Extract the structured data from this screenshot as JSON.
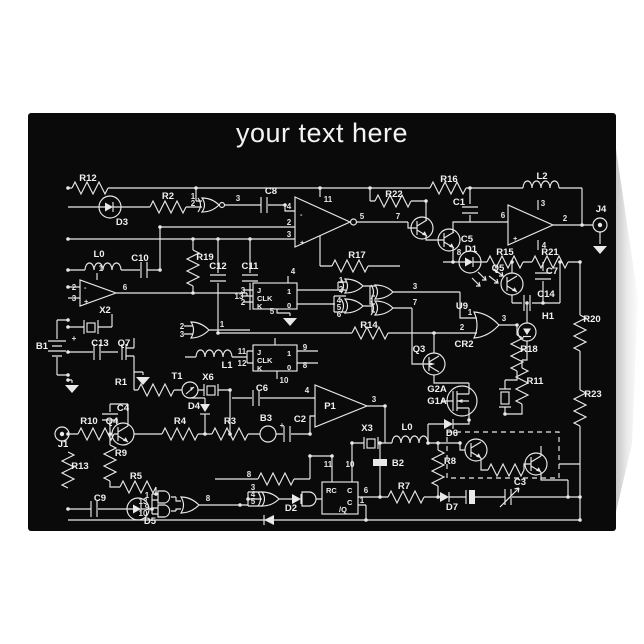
{
  "page": {
    "background_color": "#ffffff"
  },
  "card": {
    "title": "your text here",
    "front_color": "#0a0a0a",
    "line_color": "#e9e9e9",
    "title_color": "#f3f3f3",
    "back_edge_color": "#d9d9d9"
  },
  "schematic": {
    "description": "circuit-schematic-artwork",
    "component_labels": [
      {
        "t": "R12",
        "x": 88,
        "y": 181
      },
      {
        "t": "D3",
        "x": 122,
        "y": 225
      },
      {
        "t": "R2",
        "x": 168,
        "y": 199
      },
      {
        "t": "C8",
        "x": 271,
        "y": 194
      },
      {
        "t": "R22",
        "x": 394,
        "y": 197
      },
      {
        "t": "R16",
        "x": 449,
        "y": 182
      },
      {
        "t": "L2",
        "x": 542,
        "y": 179
      },
      {
        "t": "C1",
        "x": 459,
        "y": 205
      },
      {
        "t": "J4",
        "x": 601,
        "y": 212
      },
      {
        "t": "C5",
        "x": 467,
        "y": 242
      },
      {
        "t": "D1",
        "x": 471,
        "y": 252
      },
      {
        "t": "R15",
        "x": 505,
        "y": 255
      },
      {
        "t": "R21",
        "x": 550,
        "y": 255
      },
      {
        "t": "Q5",
        "x": 498,
        "y": 271
      },
      {
        "t": "C7",
        "x": 552,
        "y": 274
      },
      {
        "t": "C14",
        "x": 546,
        "y": 297
      },
      {
        "t": "L0",
        "x": 99,
        "y": 257
      },
      {
        "t": "C10",
        "x": 140,
        "y": 261
      },
      {
        "t": "R19",
        "x": 205,
        "y": 260
      },
      {
        "t": "C12",
        "x": 218,
        "y": 269
      },
      {
        "t": "C11",
        "x": 250,
        "y": 269
      },
      {
        "t": "R17",
        "x": 357,
        "y": 258
      },
      {
        "t": "R14",
        "x": 369,
        "y": 328
      },
      {
        "t": "U9",
        "x": 462,
        "y": 309
      },
      {
        "t": "CR2",
        "x": 464,
        "y": 347
      },
      {
        "t": "Q3",
        "x": 419,
        "y": 352
      },
      {
        "t": "H1",
        "x": 548,
        "y": 319
      },
      {
        "t": "R20",
        "x": 592,
        "y": 322
      },
      {
        "t": "R18",
        "x": 529,
        "y": 352
      },
      {
        "t": "R11",
        "x": 535,
        "y": 384
      },
      {
        "t": "R23",
        "x": 593,
        "y": 397
      },
      {
        "t": "G2A",
        "x": 437,
        "y": 392
      },
      {
        "t": "G1A",
        "x": 437,
        "y": 404
      },
      {
        "t": "D6",
        "x": 452,
        "y": 436
      },
      {
        "t": "X2",
        "x": 105,
        "y": 313
      },
      {
        "t": "B1",
        "x": 42,
        "y": 349
      },
      {
        "t": "C13",
        "x": 100,
        "y": 346
      },
      {
        "t": "Q7",
        "x": 124,
        "y": 346
      },
      {
        "t": "R1",
        "x": 121,
        "y": 385
      },
      {
        "t": "T1",
        "x": 177,
        "y": 379
      },
      {
        "t": "X6",
        "x": 208,
        "y": 380
      },
      {
        "t": "L1",
        "x": 227,
        "y": 368
      },
      {
        "t": "J1",
        "x": 63,
        "y": 447
      },
      {
        "t": "R10",
        "x": 89,
        "y": 424
      },
      {
        "t": "Q4",
        "x": 112,
        "y": 424
      },
      {
        "t": "C4",
        "x": 123,
        "y": 411
      },
      {
        "t": "R9",
        "x": 121,
        "y": 456
      },
      {
        "t": "R13",
        "x": 80,
        "y": 469
      },
      {
        "t": "R5",
        "x": 136,
        "y": 479
      },
      {
        "t": "C9",
        "x": 100,
        "y": 501
      },
      {
        "t": "D5",
        "x": 150,
        "y": 524
      },
      {
        "t": "R4",
        "x": 180,
        "y": 424
      },
      {
        "t": "R3",
        "x": 230,
        "y": 424
      },
      {
        "t": "B3",
        "x": 266,
        "y": 421
      },
      {
        "t": "C2",
        "x": 300,
        "y": 422
      },
      {
        "t": "C6",
        "x": 262,
        "y": 391
      },
      {
        "t": "P1",
        "x": 330,
        "y": 409
      },
      {
        "t": "X3",
        "x": 367,
        "y": 431
      },
      {
        "t": "L0",
        "x": 407,
        "y": 430
      },
      {
        "t": "B2",
        "x": 398,
        "y": 466
      },
      {
        "t": "R8",
        "x": 450,
        "y": 464
      },
      {
        "t": "R7",
        "x": 404,
        "y": 489
      },
      {
        "t": "D7",
        "x": 452,
        "y": 510
      },
      {
        "t": "C3",
        "x": 520,
        "y": 485
      },
      {
        "t": "D2",
        "x": 291,
        "y": 511
      },
      {
        "t": "D4",
        "x": 194,
        "y": 409
      }
    ],
    "pin_labels": [
      {
        "t": "1",
        "x": 193,
        "y": 199
      },
      {
        "t": "2",
        "x": 193,
        "y": 206
      },
      {
        "t": "3",
        "x": 238,
        "y": 201
      },
      {
        "t": "4",
        "x": 289,
        "y": 209
      },
      {
        "t": "2",
        "x": 289,
        "y": 225
      },
      {
        "t": "3",
        "x": 289,
        "y": 237
      },
      {
        "t": "11",
        "x": 328,
        "y": 202
      },
      {
        "t": "5",
        "x": 362,
        "y": 219
      },
      {
        "t": "7",
        "x": 398,
        "y": 219
      },
      {
        "t": "3",
        "x": 543,
        "y": 206
      },
      {
        "t": "6",
        "x": 503,
        "y": 218
      },
      {
        "t": "2",
        "x": 565,
        "y": 221
      },
      {
        "t": "4",
        "x": 544,
        "y": 248
      },
      {
        "t": "8",
        "x": 459,
        "y": 255
      },
      {
        "t": "2",
        "x": 74,
        "y": 290
      },
      {
        "t": "3",
        "x": 74,
        "y": 301
      },
      {
        "t": "1",
        "x": 101,
        "y": 271
      },
      {
        "t": "6",
        "x": 125,
        "y": 290
      },
      {
        "t": "2",
        "x": 182,
        "y": 329
      },
      {
        "t": "3",
        "x": 182,
        "y": 337
      },
      {
        "t": "1",
        "x": 222,
        "y": 327
      },
      {
        "t": "3",
        "x": 243,
        "y": 293
      },
      {
        "t": "13",
        "x": 239,
        "y": 299
      },
      {
        "t": "2",
        "x": 243,
        "y": 305
      },
      {
        "t": "4",
        "x": 293,
        "y": 274
      },
      {
        "t": "5",
        "x": 272,
        "y": 314
      },
      {
        "t": "11",
        "x": 242,
        "y": 354
      },
      {
        "t": "12",
        "x": 242,
        "y": 366
      },
      {
        "t": "9",
        "x": 305,
        "y": 350
      },
      {
        "t": "8",
        "x": 305,
        "y": 368
      },
      {
        "t": "10",
        "x": 284,
        "y": 383
      },
      {
        "t": "1",
        "x": 341,
        "y": 283
      },
      {
        "t": "2",
        "x": 341,
        "y": 292
      },
      {
        "t": "4",
        "x": 339,
        "y": 303
      },
      {
        "t": "5",
        "x": 339,
        "y": 310
      },
      {
        "t": "6",
        "x": 339,
        "y": 317
      },
      {
        "t": "3",
        "x": 415,
        "y": 289
      },
      {
        "t": "7",
        "x": 415,
        "y": 305
      },
      {
        "t": "1",
        "x": 470,
        "y": 315
      },
      {
        "t": "2",
        "x": 462,
        "y": 330
      },
      {
        "t": "3",
        "x": 504,
        "y": 321
      },
      {
        "t": "8",
        "x": 249,
        "y": 477
      },
      {
        "t": "3",
        "x": 253,
        "y": 490
      },
      {
        "t": "4",
        "x": 253,
        "y": 497
      },
      {
        "t": "5",
        "x": 253,
        "y": 504
      },
      {
        "t": "1",
        "x": 147,
        "y": 498
      },
      {
        "t": "13",
        "x": 143,
        "y": 504
      },
      {
        "t": "9",
        "x": 147,
        "y": 510
      },
      {
        "t": "10",
        "x": 143,
        "y": 516
      },
      {
        "t": "8",
        "x": 208,
        "y": 501
      },
      {
        "t": "11",
        "x": 328,
        "y": 467
      },
      {
        "t": "10",
        "x": 350,
        "y": 467
      },
      {
        "t": "6",
        "x": 366,
        "y": 493
      },
      {
        "t": "1",
        "x": 362,
        "y": 503
      },
      {
        "t": "3",
        "x": 374,
        "y": 402
      },
      {
        "t": "4",
        "x": 307,
        "y": 393
      },
      {
        "t": "+",
        "x": 74,
        "y": 341
      },
      {
        "t": "+",
        "x": 282,
        "y": 428
      }
    ],
    "ic_labels": [
      {
        "t": "J",
        "x": 257,
        "y": 293
      },
      {
        "t": "CLK",
        "x": 257,
        "y": 301
      },
      {
        "t": "K",
        "x": 257,
        "y": 309
      },
      {
        "t": "1",
        "x": 287,
        "y": 294
      },
      {
        "t": "0",
        "x": 287,
        "y": 308
      },
      {
        "t": "J",
        "x": 257,
        "y": 355
      },
      {
        "t": "CLK",
        "x": 257,
        "y": 363
      },
      {
        "t": "K",
        "x": 257,
        "y": 371
      },
      {
        "t": "1",
        "x": 287,
        "y": 356
      },
      {
        "t": "0",
        "x": 287,
        "y": 370
      },
      {
        "t": "RC",
        "x": 326,
        "y": 493
      },
      {
        "t": "C",
        "x": 347,
        "y": 493
      },
      {
        "t": "C",
        "x": 347,
        "y": 505
      },
      {
        "t": "/Q",
        "x": 339,
        "y": 512
      },
      {
        "t": "-",
        "x": 300,
        "y": 217
      },
      {
        "t": "+",
        "x": 300,
        "y": 245
      },
      {
        "t": "-",
        "x": 84,
        "y": 290
      },
      {
        "t": "+",
        "x": 84,
        "y": 304
      },
      {
        "t": "+",
        "x": 513,
        "y": 241
      }
    ]
  }
}
